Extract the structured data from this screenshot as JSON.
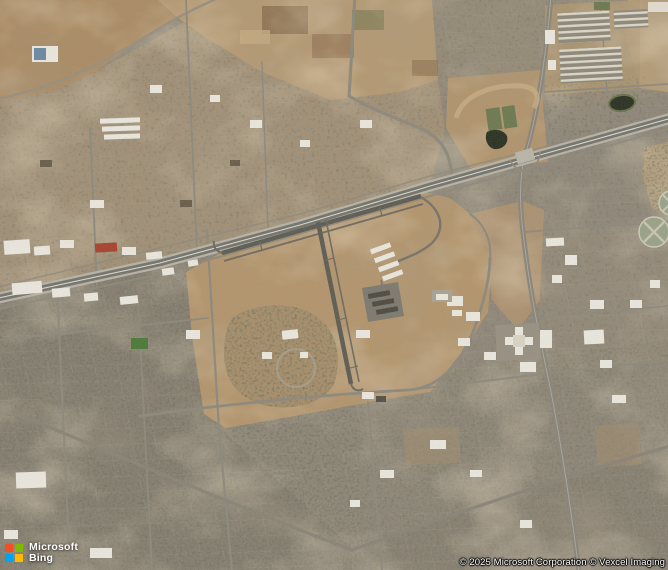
{
  "map": {
    "type": "satellite-aerial-imagery",
    "description": "Aerial satellite view of a desert city: central airfield with two crossing runways and hangars, a diagonal divided highway, dense tan-gray residential street grids, a golf-course enclave, green park patches, dark ponds, warehouse rows in the northeast, and circular water-treatment ponds at the right edge.",
    "visible_features": [
      "airfield-runways",
      "airfield-hangars",
      "diagonal-highway",
      "highway-interchange",
      "north-south-artery",
      "residential-street-grid",
      "golf-course-enclave",
      "park-green-patches",
      "dark-ponds",
      "circular-treatment-ponds",
      "warehouse-rows",
      "hospital-campus",
      "open-desert-lots"
    ]
  },
  "logo": {
    "line1": "Microsoft",
    "line2": "Bing"
  },
  "attribution": {
    "text": "© 2025 Microsoft Corporation © Vexcel Imaging"
  },
  "colors": {
    "ms-red": "#f25022",
    "ms-green": "#7fba00",
    "ms-blue": "#00a4ef",
    "ms-yellow": "#ffb900",
    "logo-text": "#ffffff",
    "attr-text": "#ffffff",
    "tan": "#b2956e",
    "urban": "#8f8779",
    "runway": "#5e5e56",
    "road": "#8d897d",
    "highway-dark": "#75756d",
    "highway-light": "#b6b2a6",
    "green-field": "#4e7a3a",
    "olive": "#6d7a52",
    "pond-dark": "#2d3424",
    "pond-circle": "#99a288",
    "building-white": "#e9e6dd",
    "building-red": "#a8442f"
  }
}
